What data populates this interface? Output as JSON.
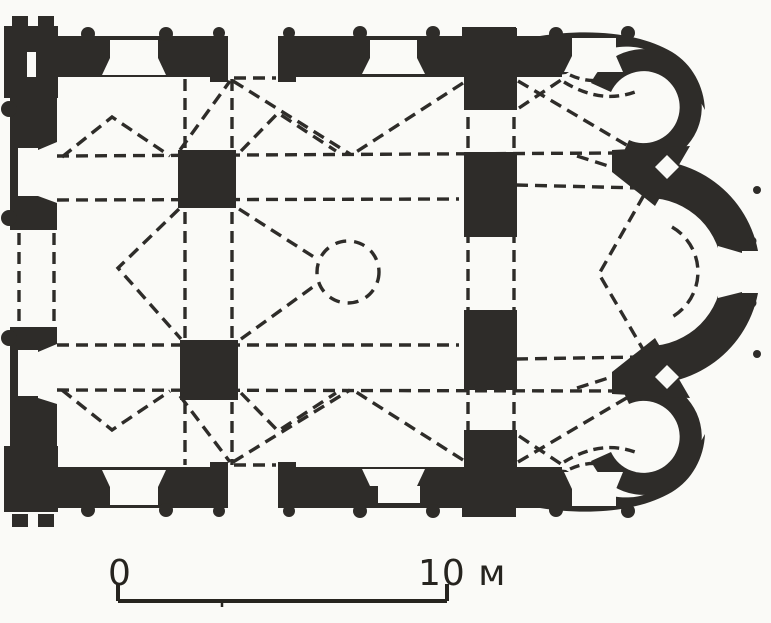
{
  "figure": {
    "kind": "Architectural floor plan of a cross-in-square church with three eastern apses",
    "ink_color": "#2e2c29",
    "paper_color": "#fafaf7"
  },
  "scale_bar": {
    "start_label": "0",
    "end_label": "10 м"
  }
}
